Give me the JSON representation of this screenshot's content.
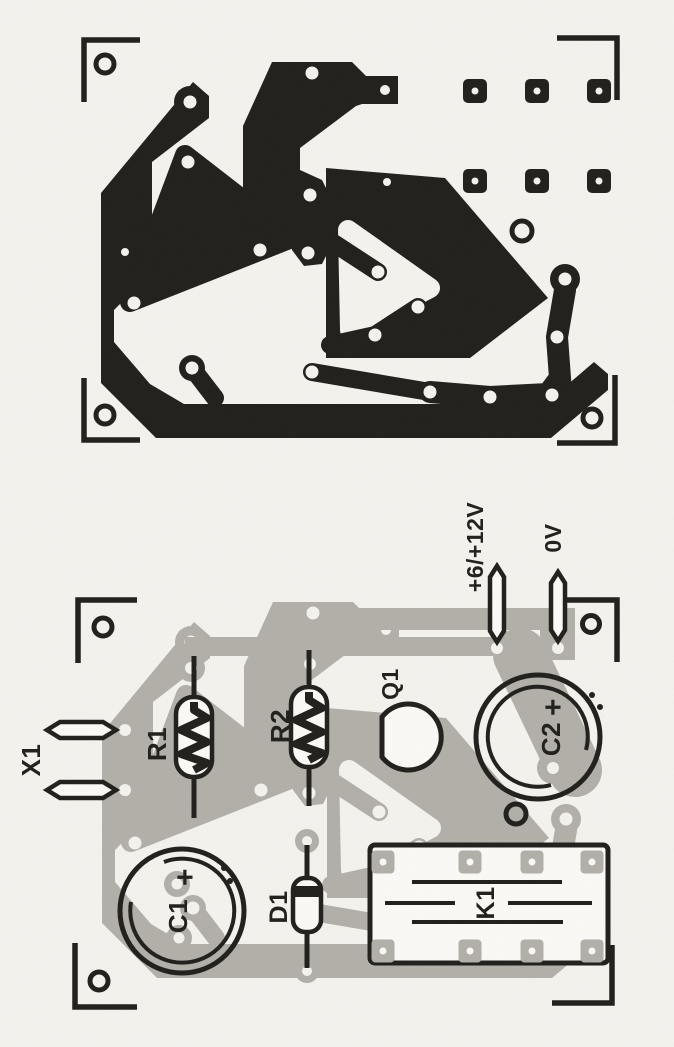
{
  "figure": {
    "kind": "printed circuit board layout, two views",
    "colors": {
      "ink": "#23211d",
      "copper_ghost": "#b3b0aa",
      "paper": "#f5f3ee"
    },
    "top_board": {
      "description": "copper track side"
    },
    "bottom_board": {
      "description": "component side",
      "labels": {
        "x1": "X1",
        "r1": "R1",
        "r2": "R2",
        "q1": "Q1",
        "c1": "C1",
        "c1_plus": "+",
        "c2": "C2",
        "c2_plus": "+",
        "d1": "D1",
        "k1": "K1",
        "supply_positive": "+6/+12V",
        "supply_zero": "0V"
      }
    }
  }
}
